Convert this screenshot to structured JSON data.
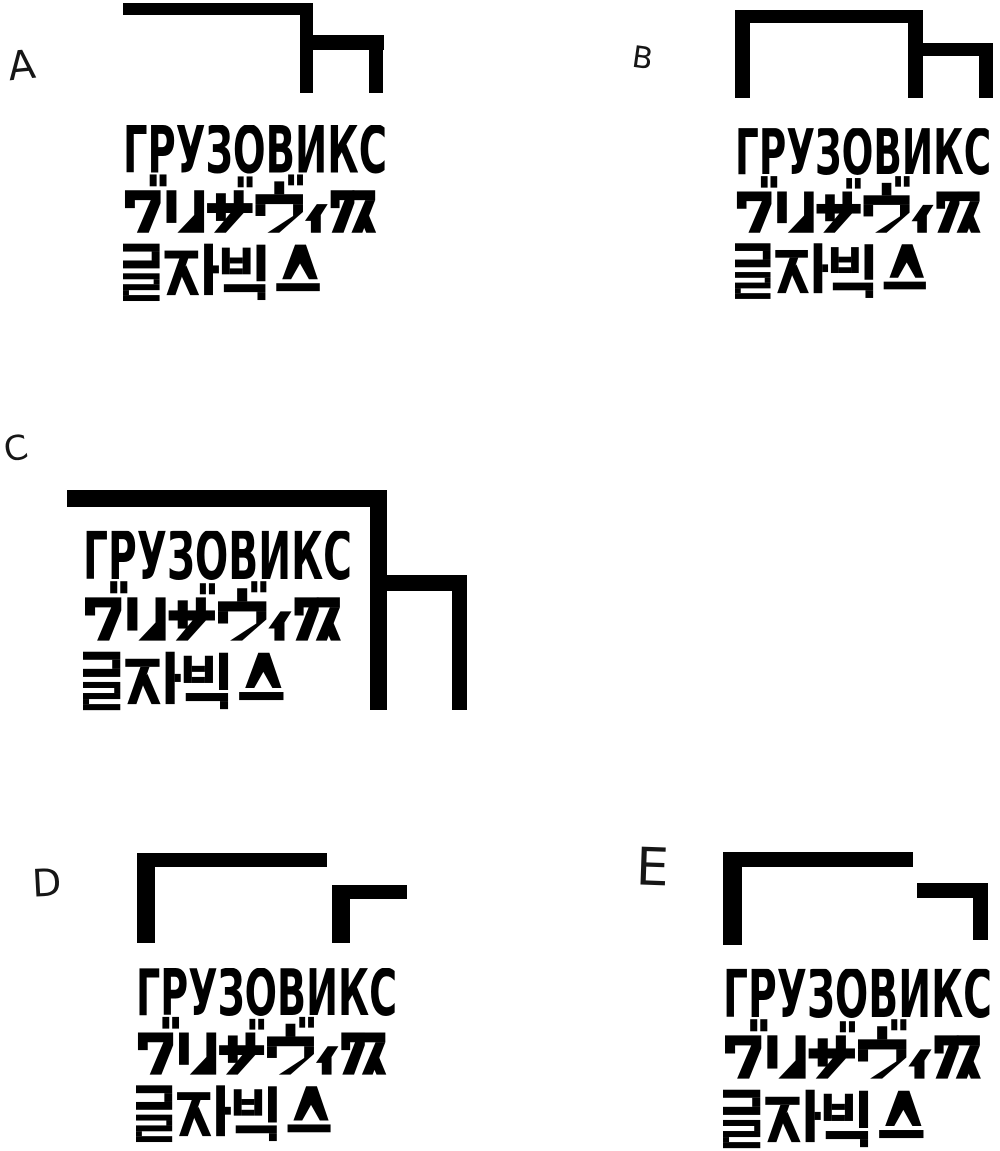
{
  "colors": {
    "ink": "#000000",
    "background": "#ffffff"
  },
  "wordmark": {
    "cyrillic": "ГРУЗОВИКС",
    "katakana": "グルザヴィクス",
    "korean": "글자빅스"
  },
  "variants": [
    {
      "label": "A"
    },
    {
      "label": "B"
    },
    {
      "label": "C"
    },
    {
      "label": "D"
    },
    {
      "label": "E"
    }
  ]
}
